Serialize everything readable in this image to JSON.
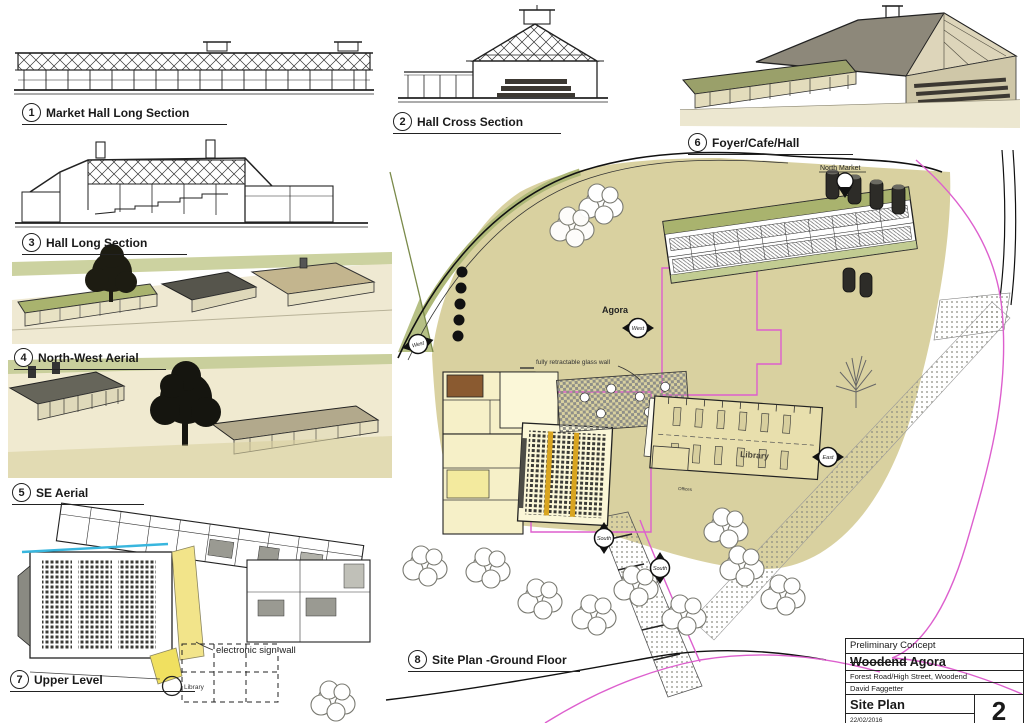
{
  "figures": [
    {
      "num": "1",
      "title": "Market Hall Long Section"
    },
    {
      "num": "2",
      "title": "Hall Cross Section"
    },
    {
      "num": "3",
      "title": "Hall Long Section"
    },
    {
      "num": "4",
      "title": "North-West Aerial"
    },
    {
      "num": "5",
      "title": "SE Aerial"
    },
    {
      "num": "6",
      "title": "Foyer/Cafe/Hall"
    },
    {
      "num": "7",
      "title": "Upper Level"
    },
    {
      "num": "8",
      "title": "Site Plan -Ground Floor"
    }
  ],
  "plan_labels": {
    "agora": "Agora",
    "north_market": "North Market",
    "west": "West",
    "east": "East",
    "south": "South",
    "glass_wall": "fully retractable glass wall",
    "sign_wall": "electronic sign wall",
    "library": "Library",
    "offices": "Offices",
    "upper_library": "Library"
  },
  "title_block": {
    "status": "Preliminary Concept",
    "project_struck": "Woodend",
    "project_rest": "Agora",
    "address": "Forest Road/High Street, Woodend",
    "author": "David Faggetter",
    "sheet_title": "Site Plan",
    "sheet_number": "2",
    "date": "22/02/2016"
  },
  "colors": {
    "ground_tan": "#d9d1a0",
    "building_cream": "#f6f0c8",
    "roof_olive": "#a9b36e",
    "accent_yellow": "#f2e48a",
    "boundary_magenta": "#dd5fce",
    "cyan_line": "#38b6de",
    "tree_dark": "#1d1c12",
    "seat_orange": "#d9a520"
  }
}
